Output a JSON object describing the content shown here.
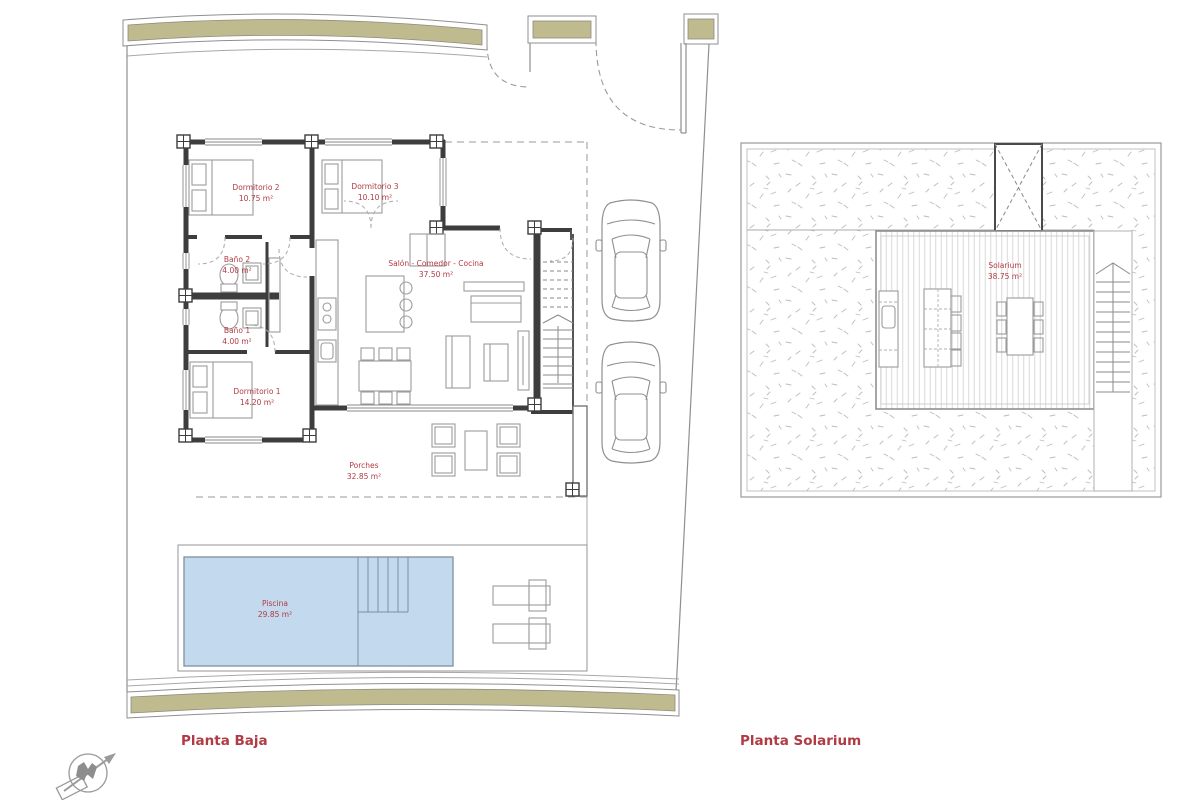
{
  "titles": {
    "planta_baja": "Planta Baja",
    "planta_solarium": "Planta Solarium"
  },
  "rooms": {
    "dormitorio2": {
      "name": "Dormitorio 2",
      "area": "10.75 m²"
    },
    "dormitorio3": {
      "name": "Dormitorio 3",
      "area": "10.10 m²"
    },
    "bano2": {
      "name": "Baño 2",
      "area": "4.00 m²"
    },
    "bano1": {
      "name": "Baño 1",
      "area": "4.00 m²"
    },
    "dormitorio1": {
      "name": "Dormitorio 1",
      "area": "14.20 m²"
    },
    "salon": {
      "name": "Salón - Comedor - Cocina",
      "area": "37.50 m²"
    },
    "porches": {
      "name": "Porches",
      "area": "32.85 m²"
    },
    "piscina": {
      "name": "Piscina",
      "area": "29.85 m²"
    },
    "solarium": {
      "name": "Solarium",
      "area": "38.75 m²"
    }
  },
  "icons": {
    "north_arrow": "north-arrow-icon"
  },
  "colors": {
    "label_red": "#b13b44",
    "wall_olive": "#bfbb8e",
    "pool_blue": "#c3d9ed",
    "line_dark": "#3d3d3d",
    "line_gray": "#8f8f8f",
    "gravel_mark": "#bdbdbd",
    "deck_stripe": "#d6d6d6"
  }
}
